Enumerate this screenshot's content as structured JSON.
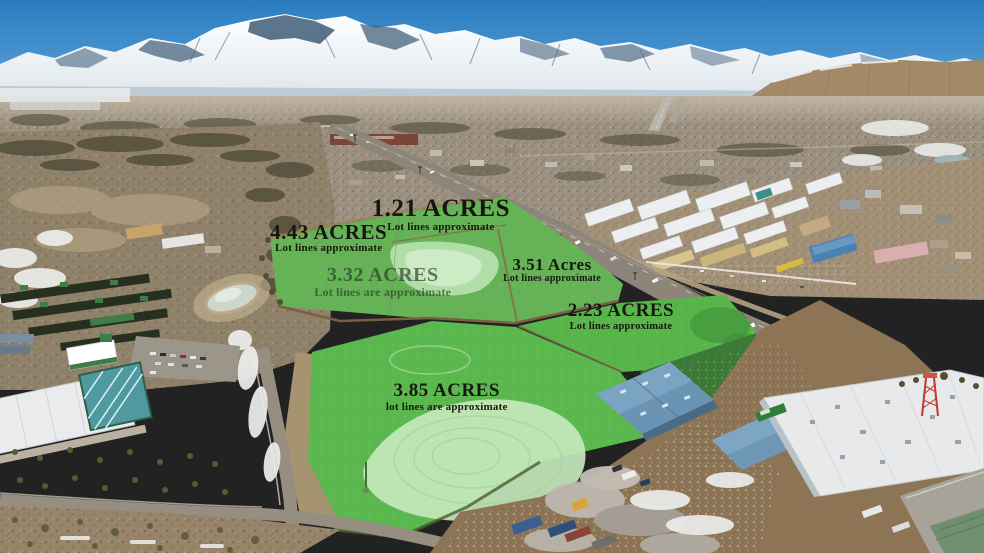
{
  "scene": {
    "description": "Aerial drone photo of commercial land parcels for sale outlined in green overlay, snow-capped mountains behind a high-desert town, a highway running diagonally, industrial buildings and a salvage yard in the foreground",
    "season_cues": "snow on mountains and scattered snow patches on ground"
  },
  "palette": {
    "sky_top": "#2a7cc0",
    "sky_horizon": "#8fc2e8",
    "snow": "#f2f6f9",
    "mountain_rock": "#3f5d78",
    "foothill": "#a28a68",
    "valley": "#9c9181",
    "scrub": "#90826a",
    "highway": "#8d8579",
    "parcel_green": "#66b257",
    "parcel_mint": "#c4e8bb",
    "parcel_dark_green": "#3c7a38",
    "warehouse_blue": "#6b94b4",
    "roof_white": "#e7e9ea",
    "pond": "#cdd6cb",
    "label_dark": "#17170f",
    "label_muted": "rgba(40,62,40,0.68)"
  },
  "parcels": [
    {
      "id": "1-21",
      "acres": "1.21 ACRES",
      "note": "Lot lines approximate",
      "variant": "dark",
      "layout": {
        "x": 44.8,
        "y": 35.2,
        "acres_px": 25,
        "note_px": 11
      }
    },
    {
      "id": "4-43",
      "acres": "4.43 ACRES",
      "note": "Lot lines approximate",
      "variant": "dark",
      "layout": {
        "x": 33.4,
        "y": 39.9,
        "acres_px": 21,
        "note_px": 11
      }
    },
    {
      "id": "3-32",
      "acres": "3.32 ACRES",
      "note": "Lot lines are approximate",
      "variant": "muted",
      "layout": {
        "x": 38.9,
        "y": 47.9,
        "acres_px": 20,
        "note_px": 12
      }
    },
    {
      "id": "3-51",
      "acres": "3.51 Acres",
      "note": "Lot lines approximate",
      "variant": "dark",
      "layout": {
        "x": 56.1,
        "y": 46.3,
        "acres_px": 17,
        "note_px": 10
      }
    },
    {
      "id": "2-23",
      "acres": "2.23 ACRES",
      "note": "Lot lines approximate",
      "variant": "dark",
      "layout": {
        "x": 63.1,
        "y": 54.4,
        "acres_px": 19,
        "note_px": 10.5
      }
    },
    {
      "id": "3-85",
      "acres": "3.85 ACRES",
      "note": "lot lines are approximate",
      "variant": "dark",
      "layout": {
        "x": 45.4,
        "y": 68.9,
        "acres_px": 19,
        "note_px": 11
      }
    }
  ]
}
